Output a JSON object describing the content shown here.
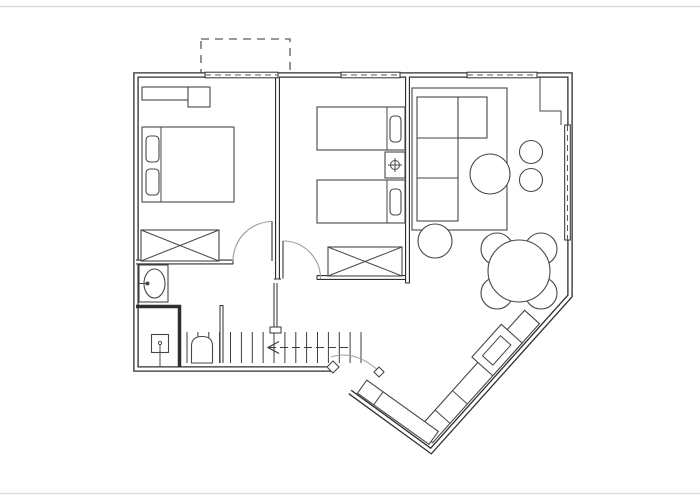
{
  "document": {
    "type": "architectural floor plan",
    "view": "top-down line drawing",
    "visible_text": [],
    "style": "thin double-line CAD walls, black on white"
  },
  "colors": {
    "background": "#ffffff",
    "wall": "#2f2f2f",
    "furniture": "#474747",
    "door-arc": "#9b9b9b",
    "tread": "#3c3c3c",
    "dash": "#5a5a5a",
    "page-edge": "#dcdcdc"
  },
  "rooms": [
    {
      "id": "bedroom-1",
      "position": "top-left",
      "furniture": [
        "double-bed",
        "two-pillows",
        "built-in-closet",
        "crossed-wardrobe"
      ]
    },
    {
      "id": "bedroom-2",
      "position": "top-middle",
      "furniture": [
        "twin-bed",
        "twin-bed",
        "nightstand-with-lamp-symbol",
        "crossed-wardrobe"
      ]
    },
    {
      "id": "living-room",
      "position": "top-right",
      "furniture": [
        "area-rug",
        "sectional-sofa",
        "round-coffee-table",
        "pouf",
        "stool",
        "stool"
      ]
    },
    {
      "id": "dining-area",
      "position": "right",
      "furniture": [
        "round-table",
        "chair",
        "chair",
        "chair",
        "chair"
      ]
    },
    {
      "id": "kitchen",
      "position": "bottom-right-diagonal",
      "furniture": [
        "angled-counter-run",
        "sink-unit",
        "counter-return"
      ]
    },
    {
      "id": "bathroom",
      "position": "bottom-left",
      "furniture": [
        "washbasin-oval",
        "shower-enclosure",
        "arched-fixture"
      ]
    },
    {
      "id": "hall",
      "position": "bottom-middle",
      "furniture": [
        "staircase",
        "direction-arrow"
      ]
    }
  ],
  "openings": {
    "windows_top_wall": 3,
    "windows_right_wall": 1,
    "interior_door_arcs": 2,
    "entry_door_arc": 1,
    "balcony_dashed_outline": true
  },
  "stairs": {
    "tread_count": 17,
    "arrow_direction": "left"
  }
}
